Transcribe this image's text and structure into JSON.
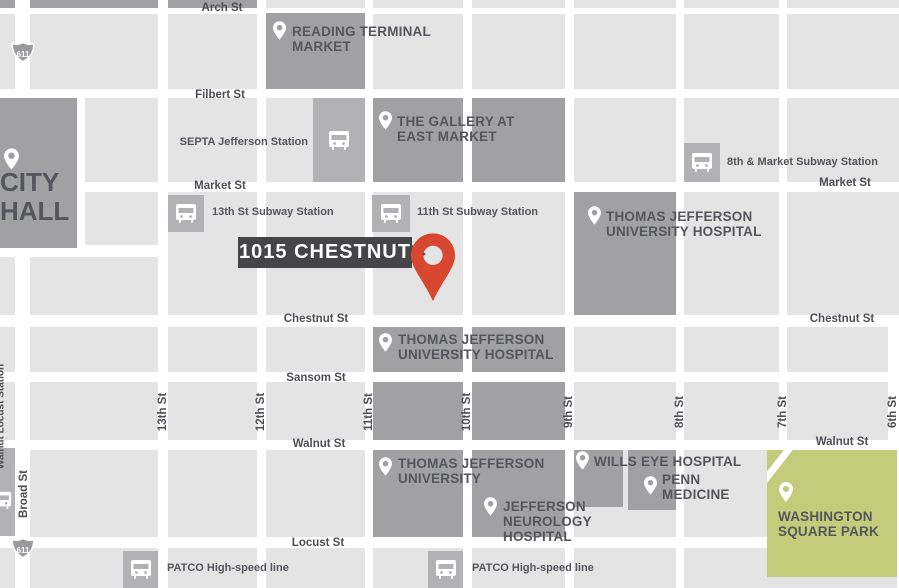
{
  "colors": {
    "block_light": "#e4e4e5",
    "block_medium": "#b2b2b5",
    "block_dark": "#a1a1a4",
    "park_green": "#c3cc7b",
    "street_white": "#ffffff",
    "label_text": "#55565b",
    "callout_bg": "#454447",
    "callout_text": "#ffffff",
    "pin_red": "#d8472f",
    "pin_white": "#ffffff"
  },
  "callout": {
    "label": "1015 CHESTNUT"
  },
  "shields": {
    "north": "611",
    "south": "611"
  },
  "street_labels": {
    "arch": "Arch St",
    "filbert": "Filbert St",
    "market_left": "Market St",
    "market_right": "Market St",
    "chestnut_left": "Chestnut St",
    "chestnut_right": "Chestnut St",
    "sansom": "Sansom St",
    "walnut_left": "Walnut St",
    "walnut_right": "Walnut St",
    "locust": "Locust St",
    "broad": "Broad St",
    "s13": "13th St",
    "s12": "12th St",
    "s11": "11th St",
    "s10": "10th St",
    "s9": "9th St",
    "s8": "8th St",
    "s7": "7th St",
    "s6": "6th St"
  },
  "landmarks": {
    "reading_terminal": "READING TERMINAL MARKET",
    "gallery": "THE GALLERY AT EAST MARKET",
    "city_hall": "CITY HALL",
    "tjuh_market": "THOMAS JEFFERSON UNIVERSITY HOSPITAL",
    "tjuh_chestnut": "THOMAS JEFFERSON UNIVERSITY HOSPITAL",
    "tju": "THOMAS JEFFERSON UNIVERSITY",
    "wills_eye": "WILLS EYE HOSPITAL",
    "penn_medicine": "PENN MEDICINE",
    "jefferson_neurology": "JEFFERSON NEUROLOGY HOSPITAL",
    "washington_square": "WASHINGTON SQUARE PARK"
  },
  "stations": {
    "septa_jefferson": "SEPTA Jefferson Station",
    "eighth_market": "8th & Market Subway Station",
    "thirteenth_subway": "13th St Subway Station",
    "eleventh_subway": "11th St Subway Station",
    "patco_west": "PATCO High-speed line",
    "patco_east": "PATCO High-speed line",
    "walnut_locust": "Walnut Locust Station"
  }
}
